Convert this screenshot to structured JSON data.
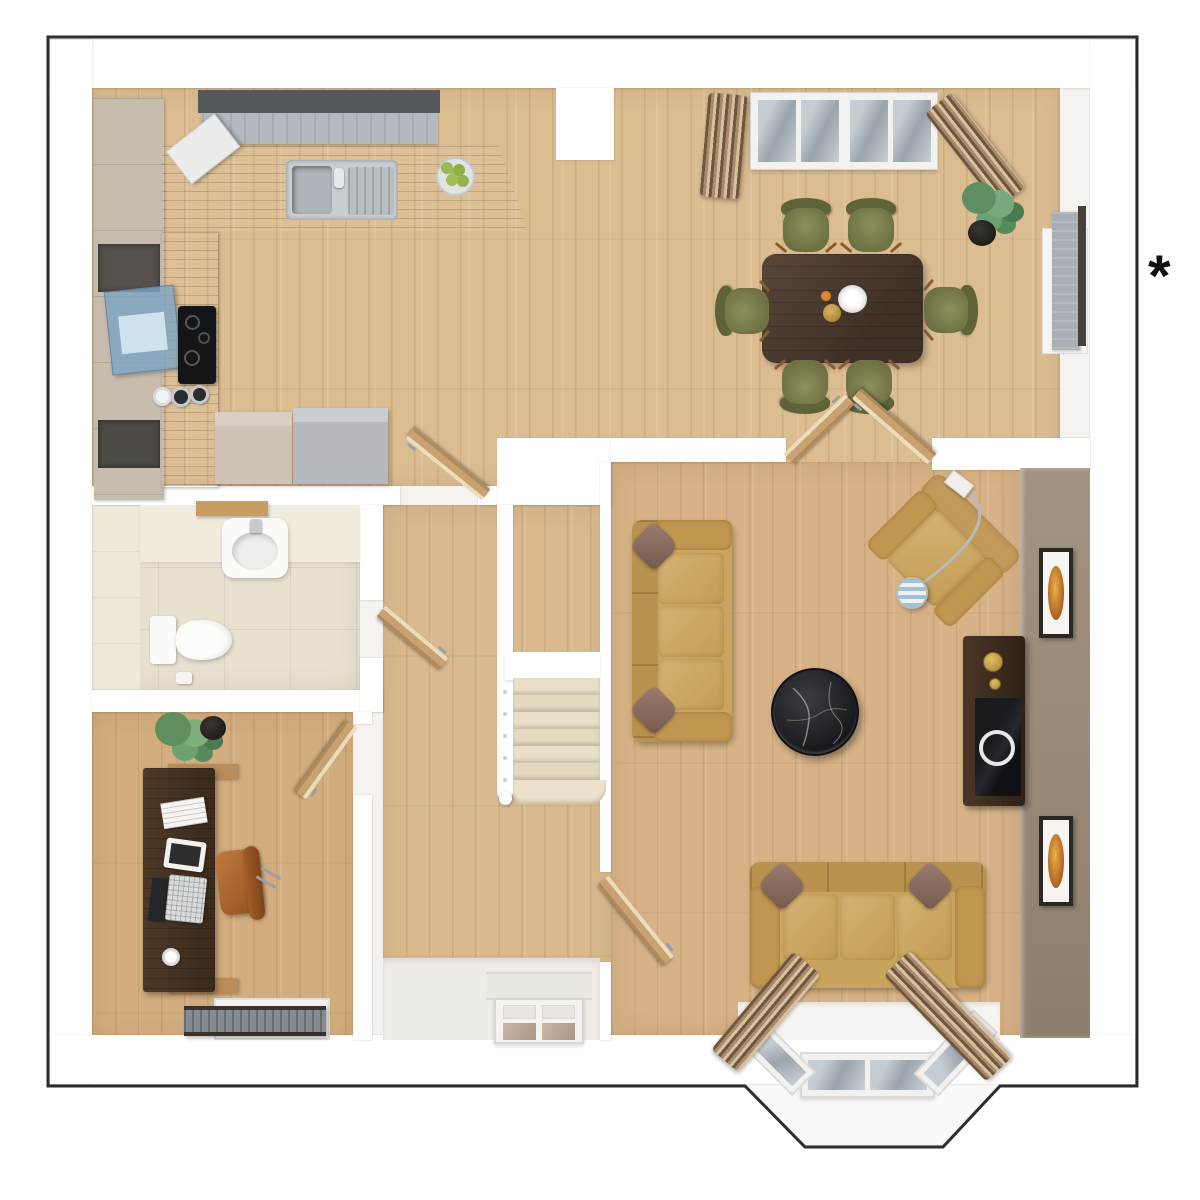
{
  "figure": {
    "type": "3d-top-down-floor-plan",
    "floor": "ground-floor"
  },
  "annotation": {
    "asterisk": "*"
  },
  "palette": {
    "outline": "#2d2d2d",
    "outer_band": "#f5f3f0",
    "wall": "#ffffff",
    "wood_floor": "#dcbd92",
    "wood_living": "#d6b286",
    "wood_study": "#d1ad7f",
    "wc_tile": "#e9e1d0",
    "kitchen_counter": "#66696d",
    "kitchen_cabinet": "#c7bcae",
    "accent_wall": "#9b8c7a",
    "sofa": "#c9a45e",
    "pillow": "#8d7164",
    "dining_chair": "#75794a",
    "dining_table": "#4a392c",
    "stair_carpet": "#e8dfc9",
    "curtain": "#a98a6b",
    "door_wood": "#c8a273",
    "coffee_table_marble": "#1b1d20",
    "wall_art": "#d98e2b",
    "window_blind": "#b4bac0",
    "hob": "#141518",
    "extractor_glass": "#7da5c3"
  }
}
